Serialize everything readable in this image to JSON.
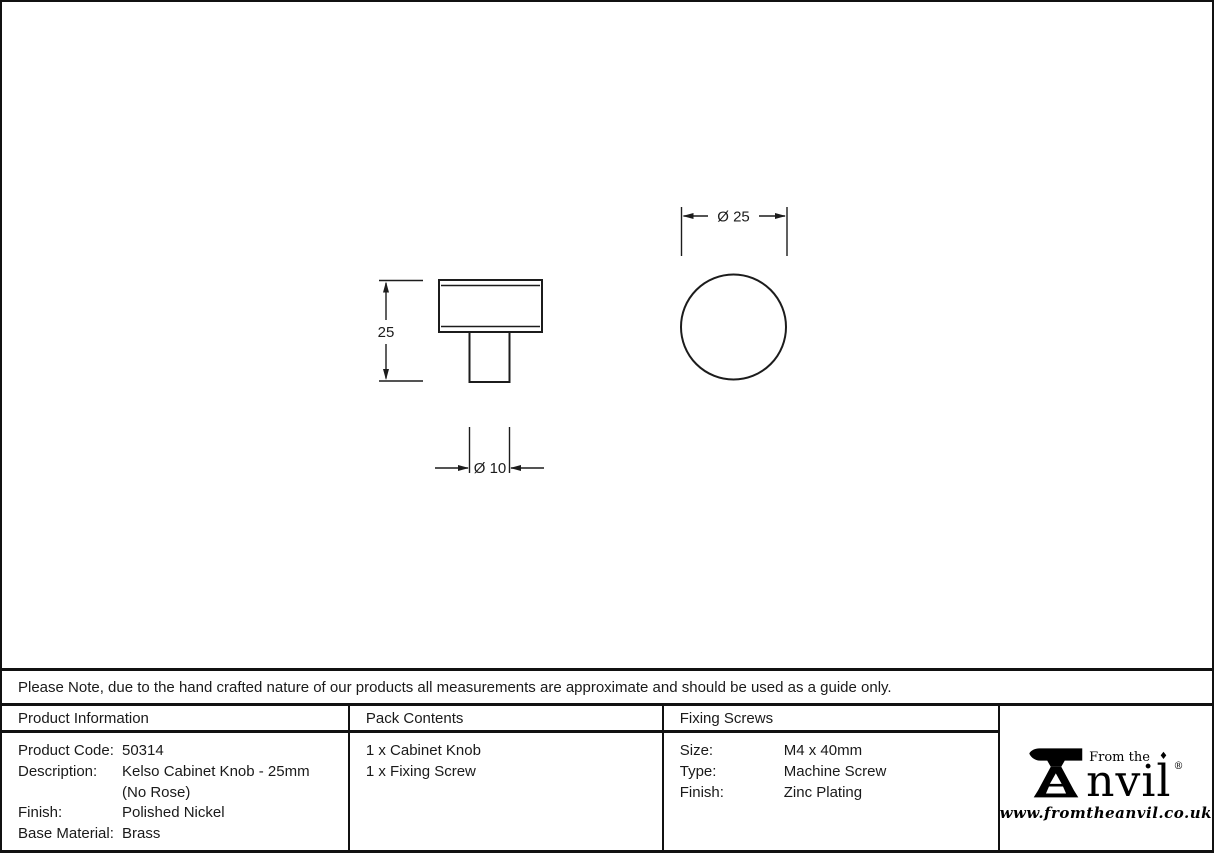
{
  "drawing": {
    "side_view": {
      "height_dim": "25",
      "stem_dim": "Ø 10"
    },
    "top_view": {
      "diameter_dim": "Ø 25"
    }
  },
  "note": "Please Note, due to the hand crafted nature of our products all measurements are approximate and should be used as a guide only.",
  "table": {
    "product_information": {
      "header": "Product Information",
      "rows": [
        {
          "label": "Product Code:",
          "value": "50314"
        },
        {
          "label": "Description:",
          "value": "Kelso Cabinet Knob - 25mm",
          "value2": "(No Rose)"
        },
        {
          "label": "Finish:",
          "value": "Polished Nickel"
        },
        {
          "label": "Base Material:",
          "value": "Brass"
        }
      ]
    },
    "pack_contents": {
      "header": "Pack Contents",
      "items": [
        "1 x Cabinet Knob",
        "1 x Fixing Screw"
      ]
    },
    "fixing_screws": {
      "header": "Fixing Screws",
      "rows": [
        {
          "label": "Size:",
          "value": "M4 x 40mm"
        },
        {
          "label": "Type:",
          "value": "Machine Screw"
        },
        {
          "label": "Finish:",
          "value": "Zinc Plating"
        }
      ]
    }
  },
  "logo": {
    "tagline": "From the",
    "diamond": "♦",
    "brand": "nvil",
    "brand_full": "From the Anvil",
    "registered": "®",
    "website": "www.fromtheanvil.co.uk"
  },
  "colors": {
    "line": "#1c1c1c",
    "border": "#111111",
    "background": "#ffffff"
  }
}
